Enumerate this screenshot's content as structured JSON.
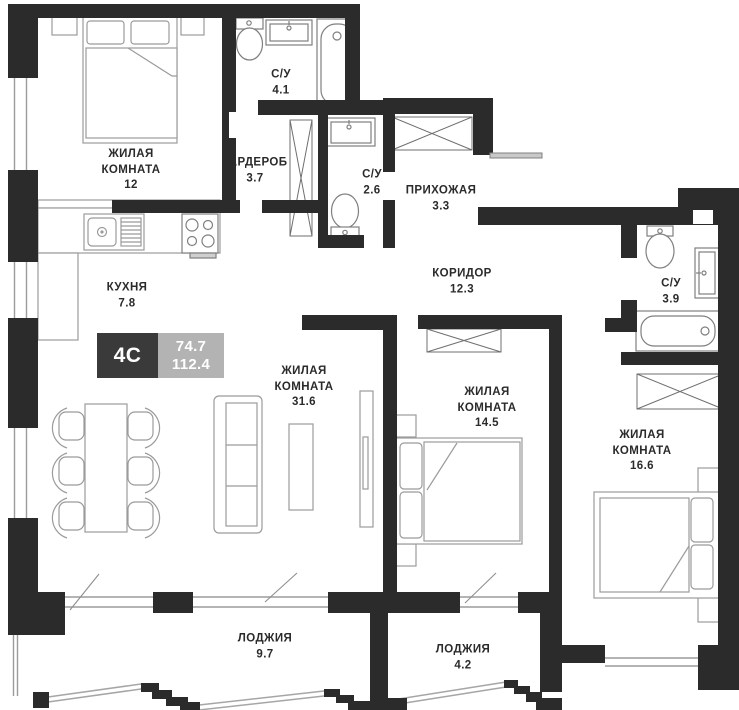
{
  "plan": {
    "badge": {
      "type_label": "4С",
      "living_area": "74.7",
      "total_area": "112.4"
    },
    "rooms": [
      {
        "id": "room-12",
        "name_lines": [
          "ЖИЛАЯ",
          "КОМНАТА"
        ],
        "area": "12"
      },
      {
        "id": "wardrobe",
        "name_lines": [
          "ГАРДЕРОБ"
        ],
        "area": "3.7"
      },
      {
        "id": "bath-4-1",
        "name_lines": [
          "С/У"
        ],
        "area": "4.1"
      },
      {
        "id": "bath-2-6",
        "name_lines": [
          "С/У"
        ],
        "area": "2.6"
      },
      {
        "id": "hallway",
        "name_lines": [
          "ПРИХОЖАЯ"
        ],
        "area": "3.3"
      },
      {
        "id": "kitchen",
        "name_lines": [
          "КУХНЯ"
        ],
        "area": "7.8"
      },
      {
        "id": "corridor",
        "name_lines": [
          "КОРИДОР"
        ],
        "area": "12.3"
      },
      {
        "id": "bath-3-9",
        "name_lines": [
          "С/У"
        ],
        "area": "3.9"
      },
      {
        "id": "room-31-6",
        "name_lines": [
          "ЖИЛАЯ",
          "КОМНАТА"
        ],
        "area": "31.6"
      },
      {
        "id": "room-14-5",
        "name_lines": [
          "ЖИЛАЯ",
          "КОМНАТА"
        ],
        "area": "14.5"
      },
      {
        "id": "room-16-6",
        "name_lines": [
          "ЖИЛАЯ",
          "КОМНАТА"
        ],
        "area": "16.6"
      },
      {
        "id": "loggia-9-7",
        "name_lines": [
          "ЛОДЖИЯ"
        ],
        "area": "9.7"
      },
      {
        "id": "loggia-4-2",
        "name_lines": [
          "ЛОДЖИЯ"
        ],
        "area": "4.2"
      }
    ],
    "colors": {
      "wall": "#2b2b2b",
      "thin_line": "#9b9b9b",
      "fixture_line": "#7f7f7f",
      "glazing_line": "#a6a6a6",
      "badge_dark": "#3a3a3a",
      "badge_gray": "#b3b3b3",
      "text": "#2b2b2b",
      "background": "#ffffff"
    }
  }
}
